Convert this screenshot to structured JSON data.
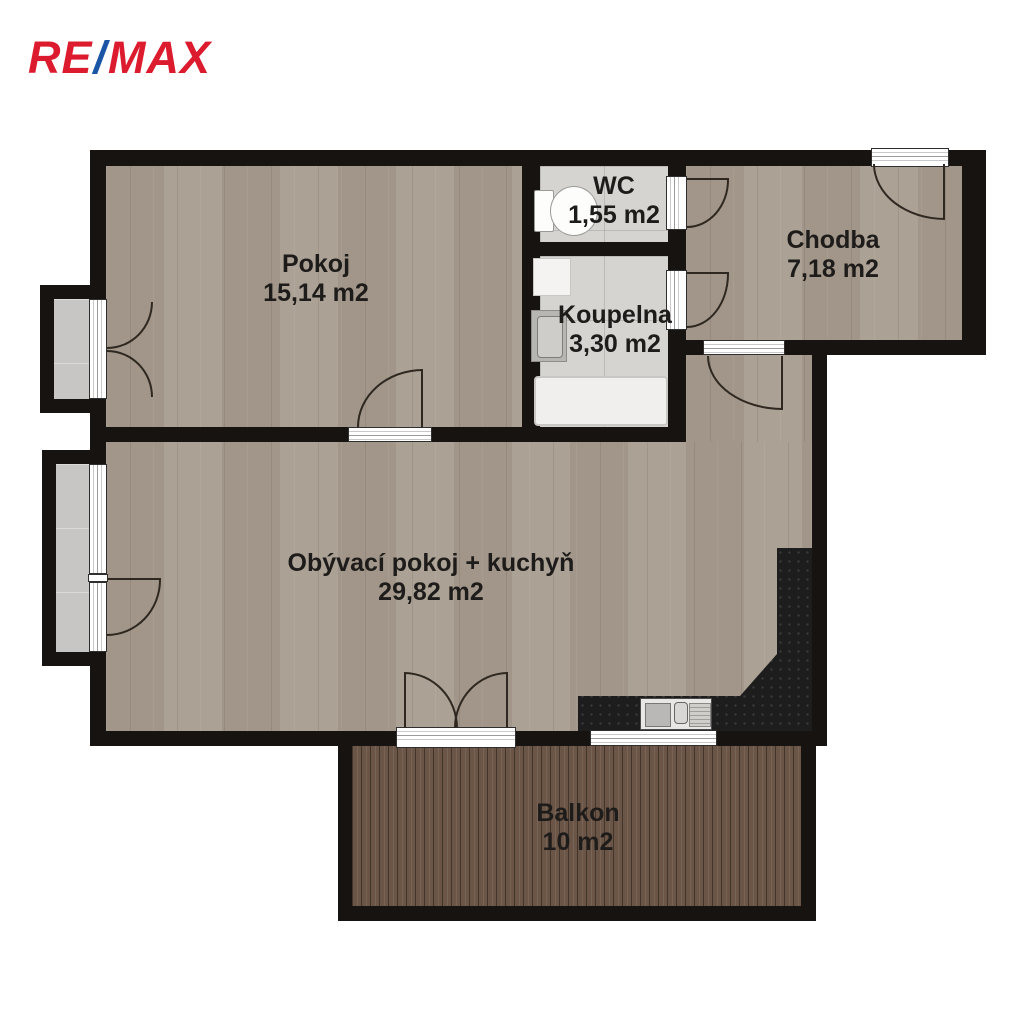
{
  "logo": {
    "re": "RE",
    "slash": "/",
    "max": "MAX"
  },
  "rooms": {
    "pokoj": {
      "name": "Pokoj",
      "area": "15,14 m2"
    },
    "wc": {
      "name": "WC",
      "area": "1,55 m2"
    },
    "koupelna": {
      "name": "Koupelna",
      "area": "3,30 m2"
    },
    "chodba": {
      "name": "Chodba",
      "area": "7,18 m2"
    },
    "obyvaci": {
      "name": "Obývací pokoj + kuchyň",
      "area": "29,82 m2"
    },
    "balkon": {
      "name": "Balkon",
      "area": "10 m2"
    }
  },
  "fixtures": [
    "toilet",
    "washing-machine",
    "washbasin",
    "bathtub",
    "kitchen-sink",
    "kitchen-counter"
  ],
  "colors": {
    "logo_red": "#DC1C2E",
    "logo_blue": "#1A56A5",
    "wall": "#161310",
    "wood_floor": "#a69b8e",
    "tile_floor": "#d6d4d1",
    "loggia_floor": "#c7c6c4",
    "balcony_deck": "#6b5546",
    "kitchen_counter": "#1d1d1d",
    "label_text": "#1e1c1a",
    "background": "#ffffff"
  }
}
